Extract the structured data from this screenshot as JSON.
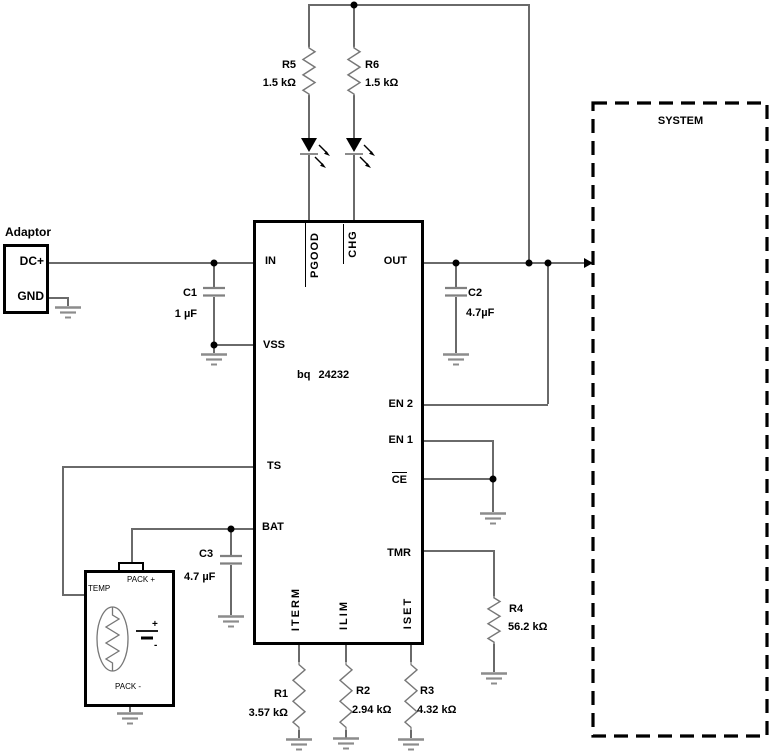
{
  "colors": {
    "ink": "#000000",
    "wire": "#6a6a6a",
    "component": "#7a7a7a"
  },
  "adaptor": {
    "title": "Adaptor",
    "pin_dcplus": "DC+",
    "pin_gnd": "GND"
  },
  "ic": {
    "part": "bq 24232",
    "pin_in": "IN",
    "pin_vss": "VSS",
    "pin_ts": "TS",
    "pin_bat": "BAT",
    "pin_out": "OUT",
    "pin_en2": "EN 2",
    "pin_en1": "EN 1",
    "pin_ce": "CE",
    "pin_tmr": "TMR",
    "pin_pgood": "PGOOD",
    "pin_chg": "CHG",
    "pin_iterm": "ITERM",
    "pin_ilim": "ILIM",
    "pin_iset": "ISET"
  },
  "system": {
    "label": "SYSTEM"
  },
  "battery": {
    "temp": "TEMP",
    "pack_plus": "PACK +",
    "pack_minus": "PACK -",
    "plus": "+",
    "minus": "-"
  },
  "components": {
    "r1": {
      "ref": "R1",
      "value": "3.57 kΩ"
    },
    "r2": {
      "ref": "R2",
      "value": "2.94 kΩ"
    },
    "r3": {
      "ref": "R3",
      "value": "4.32 kΩ"
    },
    "r4": {
      "ref": "R4",
      "value": "56.2 kΩ"
    },
    "r5": {
      "ref": "R5",
      "value": "1.5 kΩ"
    },
    "r6": {
      "ref": "R6",
      "value": "1.5 kΩ"
    },
    "c1": {
      "ref": "C1",
      "value": "1 µF"
    },
    "c2": {
      "ref": "C2",
      "value": "4.7µF"
    },
    "c3": {
      "ref": "C3",
      "value": "4.7 µF"
    }
  }
}
